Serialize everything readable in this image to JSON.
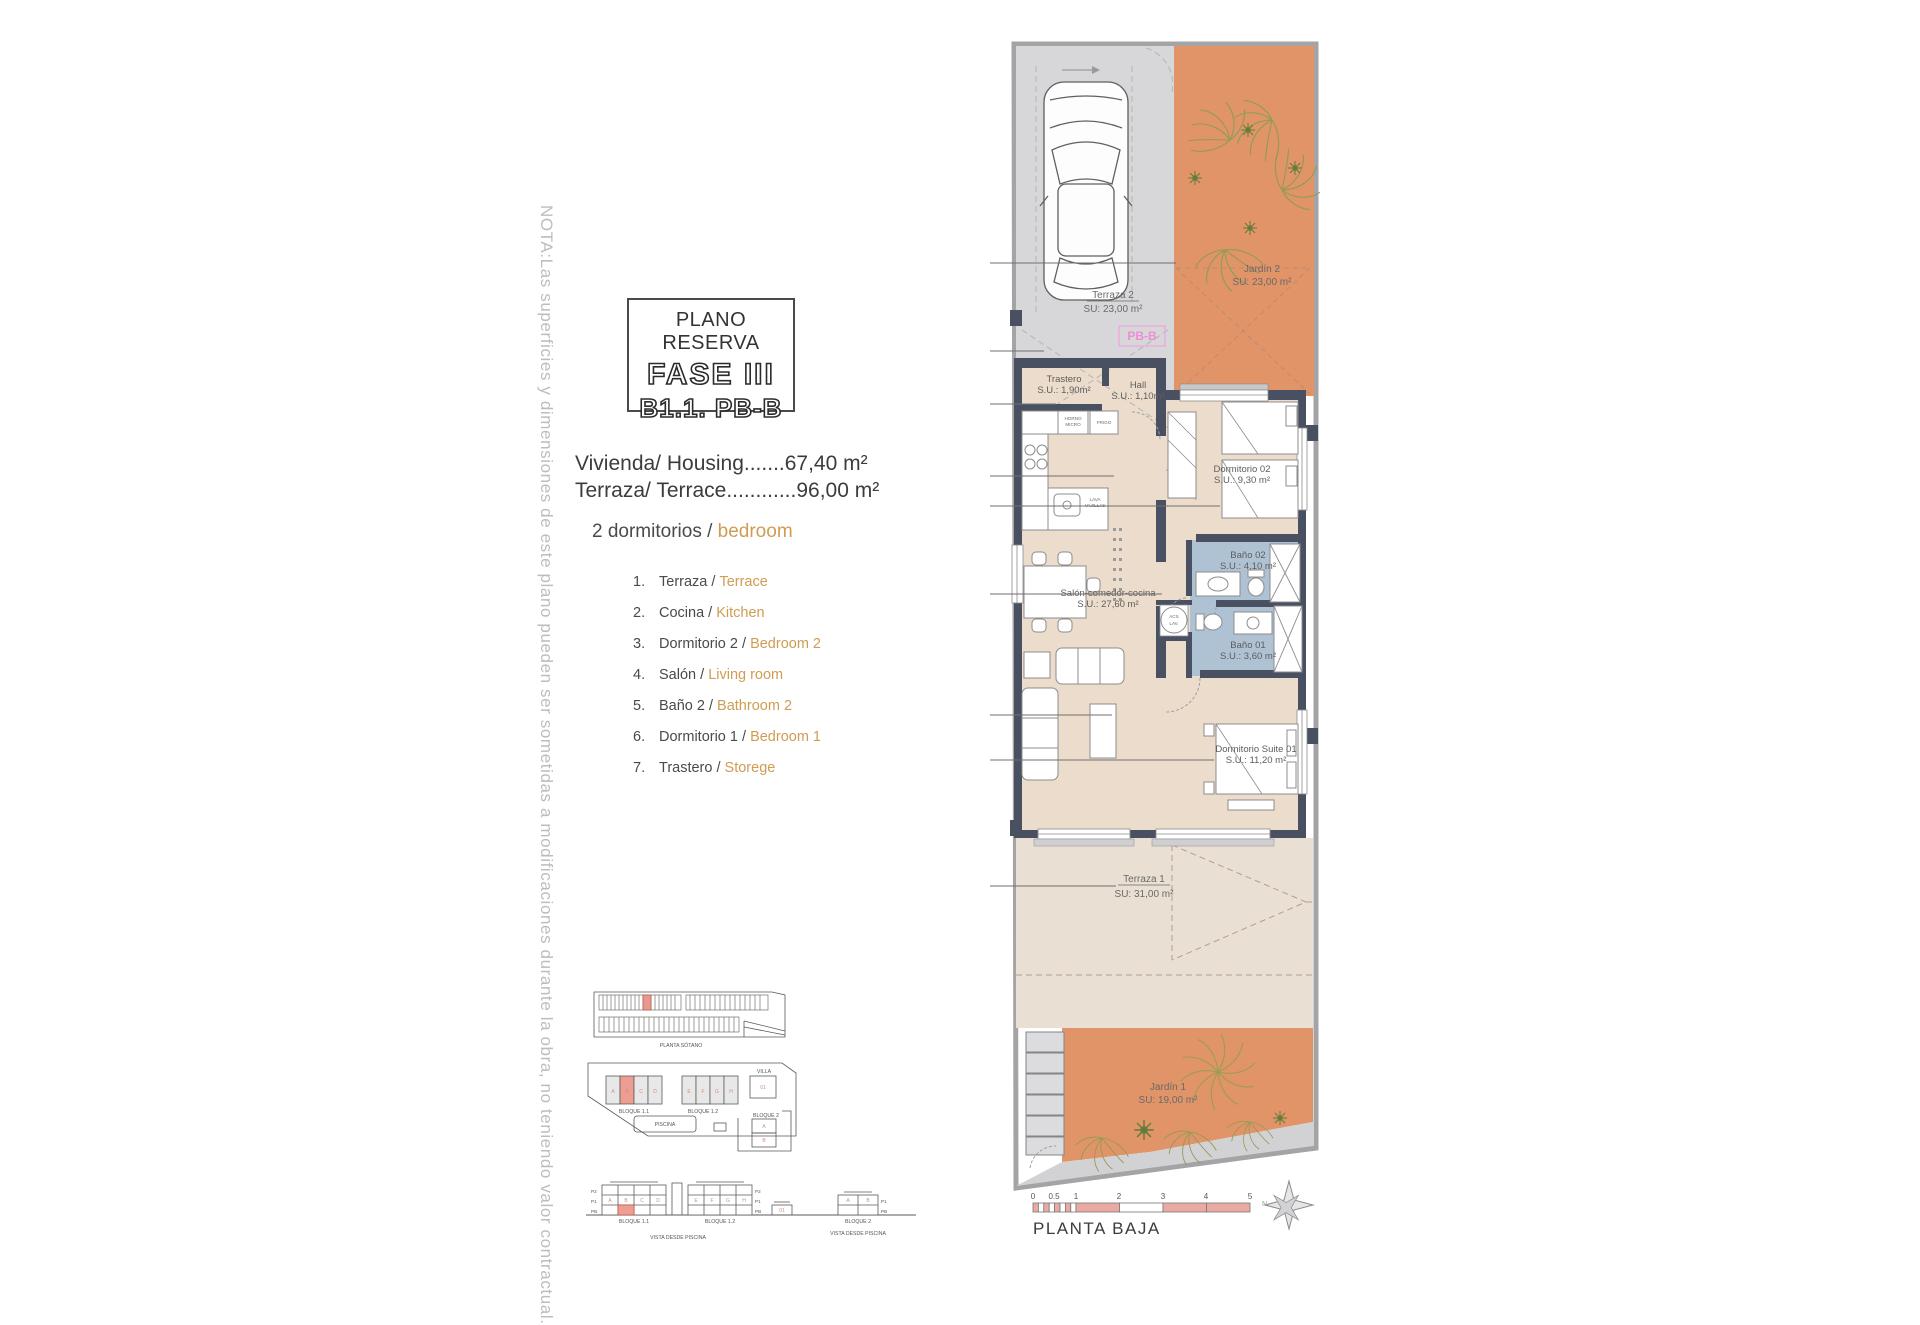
{
  "note": {
    "text": "NOTA:Las superficies y dimensiones de este plano pueden ser sometidas a modificaciones durante la obra, no teniendo valor contractual."
  },
  "title_block": {
    "line1": "PLANO RESERVA",
    "line2": "FASE III",
    "line3": "B1.1. PB-B"
  },
  "areas": {
    "housing": "Vivienda/ Housing.......67,40 m²",
    "terrace": "Terraza/ Terrace............96,00 m²"
  },
  "bedrooms": {
    "es": "2 dormitorios /",
    "en": "bedroom"
  },
  "legend": {
    "items": [
      {
        "num": "1.",
        "es": "Terraza /",
        "en": "Terrace"
      },
      {
        "num": "2.",
        "es": "Cocina /",
        "en": "Kitchen"
      },
      {
        "num": "3.",
        "es": "Dormitorio 2 /",
        "en": "Bedroom 2"
      },
      {
        "num": "4.",
        "es": "Salón /",
        "en": "Living room"
      },
      {
        "num": "5.",
        "es": "Baño 2 /",
        "en": "Bathroom 2"
      },
      {
        "num": "6.",
        "es": "Dormitorio 1 /",
        "en": "Bedroom 1"
      },
      {
        "num": "7.",
        "es": "Trastero /",
        "en": "Storege"
      }
    ]
  },
  "site_plans": {
    "sotano_caption": "PLANTA SÓTANO",
    "bloque11": "BLOQUE 1.1",
    "bloque12": "BLOQUE 1.2",
    "bloque2": "BLOQUE 2",
    "villa": "VILLA",
    "piscina": "PISCINA",
    "vista_caption": "VISTA DESDE PISCINA",
    "floors": [
      "P2",
      "P1",
      "PB"
    ],
    "units_left": [
      "A",
      "B",
      "C",
      "D"
    ],
    "units_right": [
      "E",
      "F",
      "G",
      "H"
    ],
    "bloque2_units": [
      "A",
      "B"
    ],
    "villa_unit": "01"
  },
  "plan": {
    "pb_label": "PB-B",
    "zones": {
      "terraza2": {
        "name": "Terraza 2",
        "area": "SU: 23,00 m²"
      },
      "jardin2": {
        "name": "Jardín 2",
        "area": "SU: 23,00 m²"
      },
      "terraza1": {
        "name": "Terraza 1",
        "area": "SU: 31,00 m²"
      },
      "jardin1": {
        "name": "Jardín 1",
        "area": "SU: 19,00 m²"
      }
    },
    "rooms": {
      "trastero": {
        "name": "Trastero",
        "area": "S.U.: 1,90m²"
      },
      "hall": {
        "name": "Hall",
        "area": "S.U.: 1,10m²"
      },
      "dorm2": {
        "name": "Dormitorio 02",
        "area": "S.U.: 9,30 m²"
      },
      "bano2": {
        "name": "Baño 02",
        "area": "S.U.: 4,10 m²"
      },
      "bano1": {
        "name": "Baño 01",
        "area": "S.U.: 3,60 m²"
      },
      "salon": {
        "name": "Salón-comedor-cocina",
        "area": "S.U.: 27,60 m²"
      },
      "suite": {
        "name": "Dormitorio Suite 01",
        "area": "S.U.: 11,20 m²"
      }
    },
    "appliances": {
      "horno": "HORNO",
      "micro": "MICRO",
      "frigo": "FRIGO",
      "lava1": "LAVA",
      "lava2": "VAJILLAS",
      "acs1": "ACS",
      "acs2": "LAV."
    },
    "callouts": [
      "1",
      "1",
      "7",
      "2",
      "3",
      "5",
      "4",
      "6",
      "1"
    ],
    "scale": {
      "ticks": [
        "0",
        "0.5",
        "1",
        "2",
        "3",
        "4",
        "5"
      ],
      "caption": "PLANTA BAJA",
      "north": "N"
    }
  },
  "colors": {
    "garden_orange": "#e09468",
    "interior_beige": "#ecdccb",
    "terrace_beige": "#e9dfd3",
    "driveway_gray": "#d7d7d9",
    "bath_blue": "#afc2d3",
    "wall_dark": "#485061",
    "accent_orange_text": "#cf9c52",
    "pb_pink": "#ef8cd6",
    "scalebar_salmon": "#e9aba1"
  }
}
